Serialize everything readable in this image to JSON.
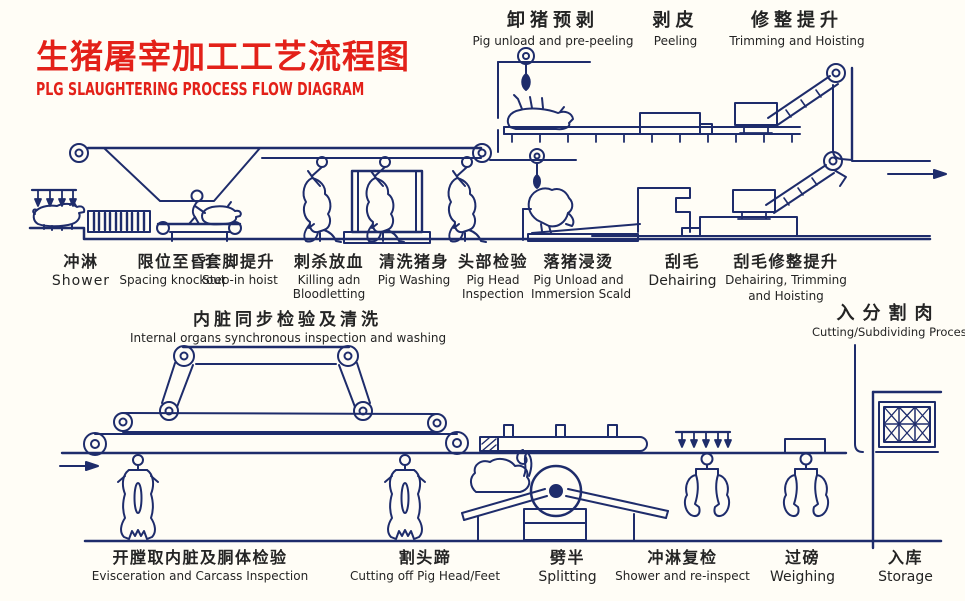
{
  "colors": {
    "line_blue": "#1e2c6b",
    "title_red": "#e32119",
    "background": "#fffdf6",
    "text": "#242424"
  },
  "title": {
    "zh": "生猪屠宰加工工艺流程图",
    "en": "PLG SLAUGHTERING PROCESS FLOW DIAGRAM"
  },
  "top_stations": [
    {
      "zh": "卸猪预剥",
      "en": "Pig unload and pre-peeling"
    },
    {
      "zh": "剥皮",
      "en": "Peeling"
    },
    {
      "zh": "修整提升",
      "en": "Trimming and Hoisting"
    }
  ],
  "mid_stations": [
    {
      "zh": "冲淋",
      "en": "Shower"
    },
    {
      "zh": "限位至昏",
      "en": "Spacing knockout"
    },
    {
      "zh": "套脚提升",
      "en": "Step-in hoist"
    },
    {
      "zh": "刺杀放血",
      "en": "Killing adn",
      "en2": "Bloodletting"
    },
    {
      "zh": "清洗猪身",
      "en": "Pig Washing"
    },
    {
      "zh": "头部检验",
      "en": "Pig Head",
      "en2": "Inspection"
    },
    {
      "zh": "落猪浸烫",
      "en": "Pig Unload and",
      "en2": "Immersion Scald"
    },
    {
      "zh": "刮毛",
      "en": "Dehairing"
    },
    {
      "zh": "刮毛修整提升",
      "en": "Dehairing, Trimming",
      "en2": "and Hoisting"
    }
  ],
  "inspection_label": {
    "zh": "内脏同步检验及清洗",
    "en": "Internal organs synchronous inspection and washing"
  },
  "cutting_label": {
    "zh": "入分割肉",
    "en": "Cutting/Subdividing Process"
  },
  "bottom_stations": [
    {
      "zh": "开膛取内脏及胴体检验",
      "en": "Evisceration and Carcass Inspection"
    },
    {
      "zh": "割头蹄",
      "en": "Cutting off Pig Head/Feet"
    },
    {
      "zh": "劈半",
      "en": "Splitting"
    },
    {
      "zh": "冲淋复检",
      "en": "Shower and re-inspect"
    },
    {
      "zh": "过磅",
      "en": "Weighing"
    },
    {
      "zh": "入库",
      "en": "Storage"
    }
  ]
}
